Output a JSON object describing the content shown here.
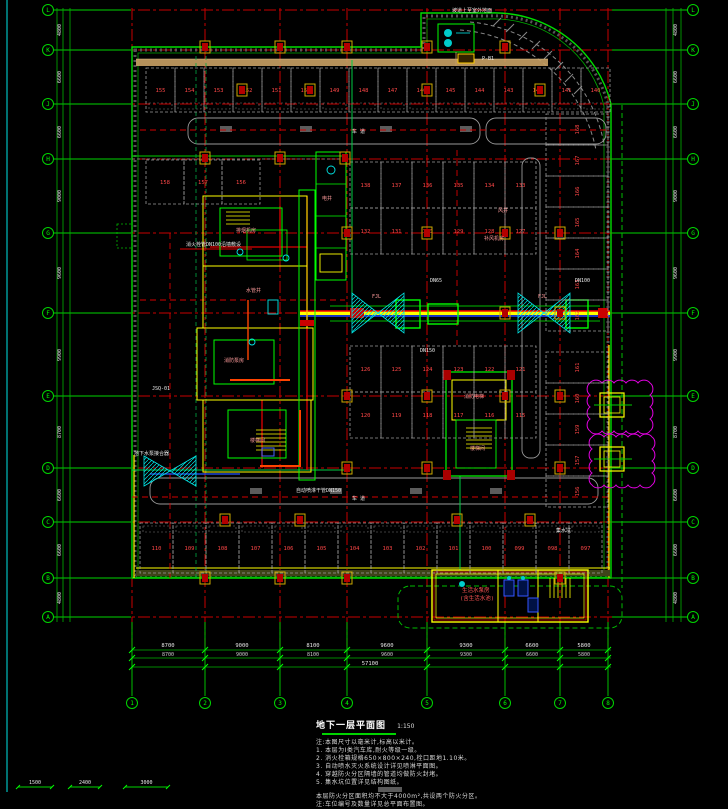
{
  "palette": {
    "bg": "#000000",
    "grid_red": "#c80000",
    "grid_green": "#00d400",
    "wall_green": "#00dd00",
    "wall_yellow": "#ffff00",
    "stall_gray": "#9a9a9a",
    "stall_number_red": "#ff4747",
    "cyan": "#00e5e5",
    "magenta": "#e000e0",
    "tan_band": "#c8a064",
    "dim_white": "#e8e8e8"
  },
  "grid": {
    "cols": [
      {
        "label": "1",
        "x": 132
      },
      {
        "label": "2",
        "x": 205
      },
      {
        "label": "3",
        "x": 280
      },
      {
        "label": "4",
        "x": 347
      },
      {
        "label": "5",
        "x": 427
      },
      {
        "label": "6",
        "x": 505
      },
      {
        "label": "7",
        "x": 560
      },
      {
        "label": "8",
        "x": 608
      }
    ],
    "rows": [
      {
        "label": "L",
        "y": 10
      },
      {
        "label": "K",
        "y": 50
      },
      {
        "label": "J",
        "y": 104
      },
      {
        "label": "H",
        "y": 159
      },
      {
        "label": "G",
        "y": 233
      },
      {
        "label": "F",
        "y": 313
      },
      {
        "label": "E",
        "y": 396
      },
      {
        "label": "D",
        "y": 468
      },
      {
        "label": "C",
        "y": 522
      },
      {
        "label": "B",
        "y": 578
      },
      {
        "label": "A",
        "y": 617
      }
    ]
  },
  "dimensions": {
    "bottom_spans": [
      {
        "text": "8700",
        "mid": 168
      },
      {
        "text": "9000",
        "mid": 242
      },
      {
        "text": "8100",
        "mid": 313
      },
      {
        "text": "9600",
        "mid": 387
      },
      {
        "text": "9300",
        "mid": 466
      },
      {
        "text": "6600",
        "mid": 532
      },
      {
        "text": "5800",
        "mid": 584
      }
    ],
    "bottom_total": {
      "text": "57100",
      "mid": 370
    },
    "side_spans": [
      {
        "text": "4800",
        "mid": 30
      },
      {
        "text": "6600",
        "mid": 77
      },
      {
        "text": "6600",
        "mid": 132
      },
      {
        "text": "9000",
        "mid": 196
      },
      {
        "text": "9600",
        "mid": 273
      },
      {
        "text": "9900",
        "mid": 355
      },
      {
        "text": "8700",
        "mid": 432
      },
      {
        "text": "6600",
        "mid": 495
      },
      {
        "text": "6600",
        "mid": 550
      },
      {
        "text": "4800",
        "mid": 598
      }
    ],
    "corner_dims": [
      {
        "x1": 18,
        "x2": 52,
        "text": "1500"
      },
      {
        "x1": 70,
        "x2": 100,
        "text": "2400"
      },
      {
        "x1": 125,
        "x2": 168,
        "text": "3000"
      }
    ]
  },
  "parking": {
    "groups": [
      {
        "name": "top-row",
        "dir": "h",
        "x": 146,
        "y": 68,
        "w": 29,
        "h": 44,
        "sub": "bottom",
        "numbers": [
          "155",
          "154",
          "153",
          "152",
          "151",
          "150",
          "149",
          "148",
          "147",
          "146",
          "145",
          "144",
          "143",
          "142",
          "141",
          "140"
        ]
      },
      {
        "name": "row2-left",
        "dir": "h",
        "x": 146,
        "y": 160,
        "w": 38,
        "h": 44,
        "sub": "none",
        "numbers": [
          "158",
          "157",
          "156"
        ]
      },
      {
        "name": "mid-row-1",
        "dir": "h",
        "x": 350,
        "y": 162,
        "w": 31,
        "h": 46,
        "sub": "none",
        "numbers": [
          "138",
          "137",
          "136",
          "135",
          "134",
          "133"
        ]
      },
      {
        "name": "mid-row-2",
        "dir": "h",
        "x": 350,
        "y": 208,
        "w": 31,
        "h": 46,
        "sub": "none",
        "numbers": [
          "132",
          "131",
          "130",
          "129",
          "128",
          "127"
        ]
      },
      {
        "name": "mid-row-3",
        "dir": "h",
        "x": 350,
        "y": 346,
        "w": 31,
        "h": 46,
        "sub": "none",
        "numbers": [
          "126",
          "125",
          "124",
          "123",
          "122",
          "121"
        ]
      },
      {
        "name": "mid-row-4",
        "dir": "h",
        "x": 350,
        "y": 392,
        "w": 31,
        "h": 46,
        "sub": "none",
        "numbers": [
          "120",
          "119",
          "118",
          "117",
          "116",
          "115"
        ]
      },
      {
        "name": "right-col-top",
        "dir": "v",
        "x": 546,
        "y": 114,
        "w": 62,
        "h": 31,
        "sub": "none",
        "numbers": [
          "168",
          "167",
          "166",
          "165",
          "164",
          "163",
          "162"
        ]
      },
      {
        "name": "right-col-bottom",
        "dir": "v",
        "x": 546,
        "y": 352,
        "w": 62,
        "h": 31,
        "sub": "none",
        "numbers": [
          "161",
          "160",
          "159",
          "157",
          "156"
        ]
      },
      {
        "name": "bottom-row",
        "dir": "h",
        "x": 140,
        "y": 523,
        "w": 33,
        "h": 50,
        "sub": "top",
        "numbers": [
          "110",
          "109",
          "108",
          "107",
          "106",
          "105",
          "104",
          "103",
          "102",
          "101",
          "100",
          "099",
          "098",
          "097"
        ]
      }
    ]
  },
  "structure_columns": [
    [
      205,
      47
    ],
    [
      280,
      47
    ],
    [
      347,
      47
    ],
    [
      427,
      47
    ],
    [
      505,
      47
    ],
    [
      242,
      90
    ],
    [
      310,
      90
    ],
    [
      427,
      90
    ],
    [
      540,
      90
    ],
    [
      205,
      158
    ],
    [
      280,
      158
    ],
    [
      345,
      158
    ],
    [
      347,
      233
    ],
    [
      427,
      233
    ],
    [
      505,
      233
    ],
    [
      560,
      233
    ],
    [
      505,
      313
    ],
    [
      560,
      313
    ],
    [
      347,
      396
    ],
    [
      427,
      396
    ],
    [
      505,
      396
    ],
    [
      560,
      396
    ],
    [
      347,
      468
    ],
    [
      427,
      468
    ],
    [
      560,
      468
    ],
    [
      225,
      520
    ],
    [
      300,
      520
    ],
    [
      457,
      520
    ],
    [
      530,
      520
    ],
    [
      205,
      578
    ],
    [
      280,
      578
    ],
    [
      347,
      578
    ],
    [
      560,
      578
    ]
  ],
  "labels": {
    "white": [
      {
        "x": 452,
        "y": 12,
        "t": "坡道上至室外地面"
      },
      {
        "x": 482,
        "y": 60,
        "t": "P-B1"
      },
      {
        "x": 352,
        "y": 133,
        "t": "车 道"
      },
      {
        "x": 352,
        "y": 500,
        "t": "车 道"
      },
      {
        "x": 186,
        "y": 246,
        "t": "消火栓管DN100沿墙敷设"
      },
      {
        "x": 152,
        "y": 390,
        "t": "JSQ-01"
      },
      {
        "x": 134,
        "y": 455,
        "t": "地下水泵接合器"
      },
      {
        "x": 420,
        "y": 352,
        "t": "DN150"
      },
      {
        "x": 556,
        "y": 532,
        "t": "集水坑"
      },
      {
        "x": 296,
        "y": 492,
        "t": "自动喷淋干管DN150"
      },
      {
        "x": 575,
        "y": 282,
        "t": "DN100"
      },
      {
        "x": 430,
        "y": 282,
        "t": "DN65"
      }
    ],
    "pink": [
      {
        "x": 236,
        "y": 232,
        "t": "排烟机房"
      },
      {
        "x": 246,
        "y": 292,
        "t": "水管井"
      },
      {
        "x": 224,
        "y": 362,
        "t": "消防泵房"
      },
      {
        "x": 250,
        "y": 442,
        "t": "楼梯间"
      },
      {
        "x": 322,
        "y": 200,
        "t": "电井"
      },
      {
        "x": 464,
        "y": 398,
        "t": "消防电梯"
      },
      {
        "x": 470,
        "y": 450,
        "t": "楼梯间"
      },
      {
        "x": 498,
        "y": 212,
        "t": "风井"
      },
      {
        "x": 484,
        "y": 240,
        "t": "补风机房"
      },
      {
        "x": 372,
        "y": 298,
        "t": "FJL"
      },
      {
        "x": 538,
        "y": 298,
        "t": "FJL"
      }
    ],
    "red": [
      {
        "x": 462,
        "y": 592,
        "t": "生活水泵房"
      },
      {
        "x": 460,
        "y": 600,
        "t": "(含生活水池)"
      }
    ]
  },
  "title": {
    "text": "地下一层平面图",
    "scale": "1:150"
  },
  "notes": [
    "注:本图尺寸以毫米计,标高以米计。",
    "1. 本层为Ⅰ类汽车库,耐火等级一级。",
    "2. 消火栓箱规格650×800×240,栓口距地1.10米。",
    "3. 自动喷水灭火系统设计详见喷淋平面图。",
    "4. 穿越防火分区隔墙的管道均做防火封堵。",
    "5. 集水坑位置详见结构图纸。"
  ],
  "notes2": [
    "本层防火分区面积均不大于4000m²,共设两个防火分区。",
    "注:车位编号及数量详见总平面布置图。"
  ]
}
